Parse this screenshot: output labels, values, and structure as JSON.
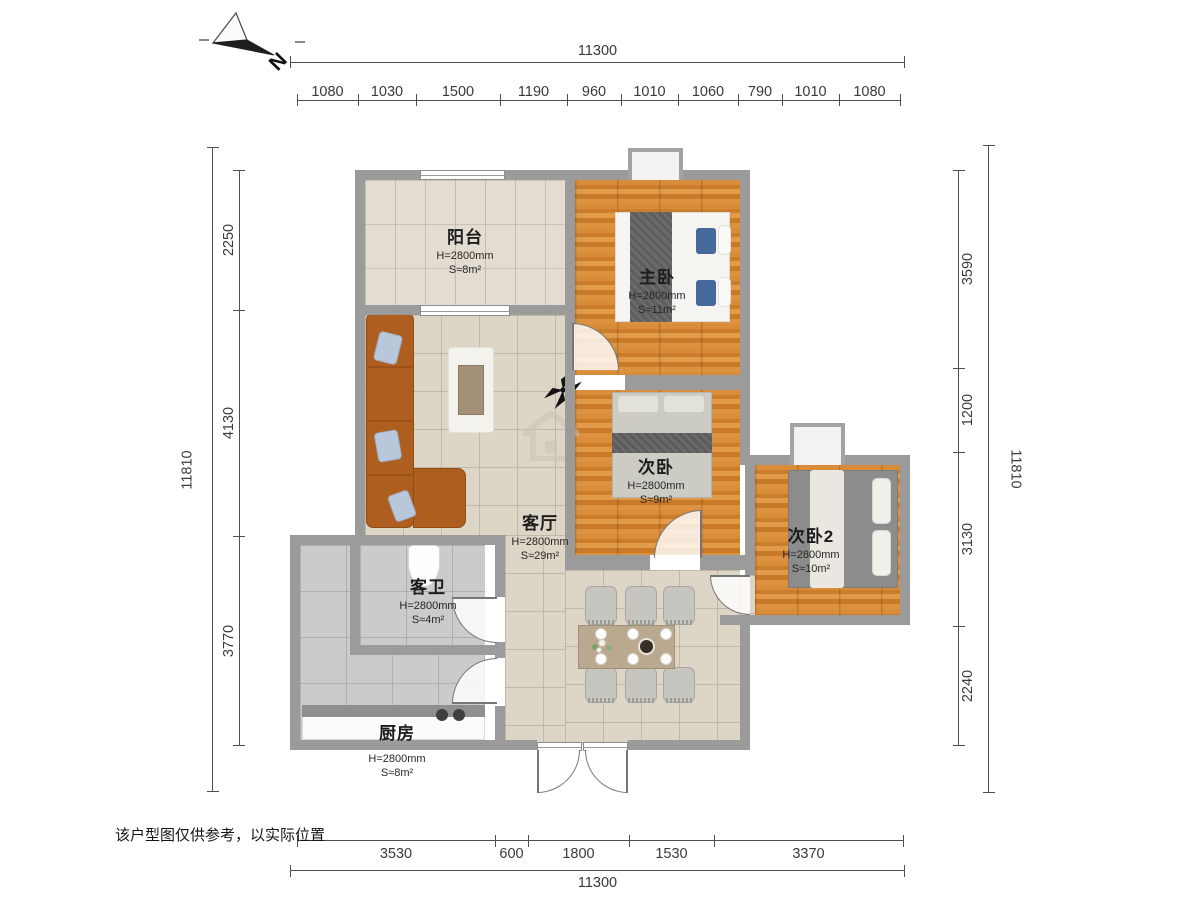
{
  "compass": {
    "label": "N"
  },
  "disclaimer": "该户型图仅供参考，以实际位置",
  "dimensions": {
    "top": {
      "total": "11300",
      "segments": [
        "1080",
        "1030",
        "1500",
        "1190",
        "960",
        "1010",
        "1060",
        "790",
        "1010",
        "1080"
      ]
    },
    "bottom": {
      "total": "11300",
      "segments": [
        "3530",
        "600",
        "1800",
        "1530",
        "3370"
      ]
    },
    "left": {
      "total": "11810",
      "segments": [
        "2250",
        "4130",
        "3770"
      ]
    },
    "right": {
      "total": "11810",
      "segments": [
        "3590",
        "1200",
        "3130",
        "2240"
      ]
    }
  },
  "rooms": {
    "balcony": {
      "name": "阳台",
      "height": "H=2800mm",
      "area": "S≈8m²"
    },
    "master": {
      "name": "主卧",
      "height": "H=2800mm",
      "area": "S≈11m²"
    },
    "bedroom2": {
      "name": "次卧",
      "height": "H=2800mm",
      "area": "S≈9m²"
    },
    "bedroom3": {
      "name": "次卧2",
      "height": "H=2800mm",
      "area": "S≈10m²"
    },
    "living": {
      "name": "客厅",
      "height": "H=2800mm",
      "area": "S≈29m²"
    },
    "bath": {
      "name": "客卫",
      "height": "H=2800mm",
      "area": "S≈4m²"
    },
    "kitchen": {
      "name": "厨房",
      "height": "H=2800mm",
      "area": "S≈8m²"
    }
  },
  "colors": {
    "wall": "#9b9b9b",
    "wood": "#d98d39",
    "tile": "#ddd5c6",
    "accent_pillow": "#46699c"
  }
}
